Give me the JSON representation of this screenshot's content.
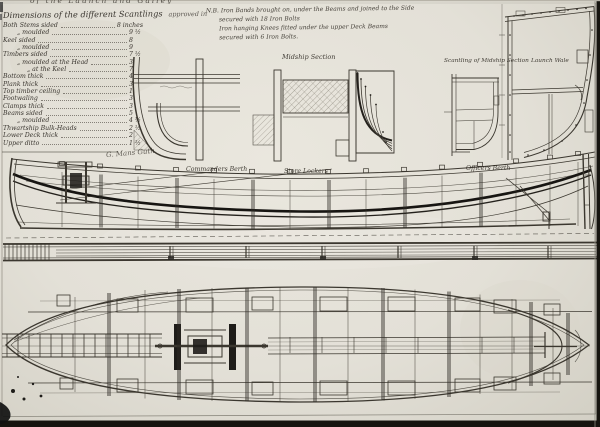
{
  "sheet": {
    "header_fragment": "of the Launch and Galley",
    "signature": "G. Mans Guth"
  },
  "scantlings": {
    "title": "Dimensions of the different Scantlings",
    "title_suffix": "approved in",
    "rows": [
      {
        "label": "Both Stems sided",
        "value": "8 inches"
      },
      {
        "label": "„  moulded",
        "value": "9 ½"
      },
      {
        "label": "Keel sided",
        "value": "8"
      },
      {
        "label": "„  moulded",
        "value": "9"
      },
      {
        "label": "Timbers sided",
        "value": "7 ½"
      },
      {
        "label": "„  moulded at the Head",
        "value": "3"
      },
      {
        "label": "„  at the Keel",
        "value": "7"
      },
      {
        "label": "Bottom thick",
        "value": "4"
      },
      {
        "label": "Plank thick",
        "value": "3"
      },
      {
        "label": "Top timber ceiling",
        "value": "1"
      },
      {
        "label": "Footwaling",
        "value": "3"
      },
      {
        "label": "Clamps thick",
        "value": "3"
      },
      {
        "label": "Beams sided",
        "value": "5"
      },
      {
        "label": "„  moulded",
        "value": "4 ½"
      },
      {
        "label": "Thwartship Bulk-Heads",
        "value": "2 ½"
      },
      {
        "label": "Lower Deck thick",
        "value": "2"
      },
      {
        "label": "Upper ditto",
        "value": "1 ½"
      }
    ]
  },
  "nb_note": {
    "line1": "N.B. Iron Bands brought on, under the Beams and joined to the Side",
    "line2": "secured with 18 Iron Bolts",
    "line3": "Iron hanging Knees fitted under the upper Deck Beams",
    "line4": "secured with 6 Iron Bolts."
  },
  "labels": {
    "midship_section": "Midship Section",
    "scantling_section": "Scantling of Midship Section",
    "wale": "Launch Wale",
    "berth_left": "Commanders Berth",
    "berth_mid": "Store Lockers",
    "berth_right": "Officers Berth"
  },
  "colors": {
    "paper": "#e3e0d7",
    "ink": "#33302b",
    "ink_heavy": "#171512",
    "photo_edge": "#16140f"
  }
}
